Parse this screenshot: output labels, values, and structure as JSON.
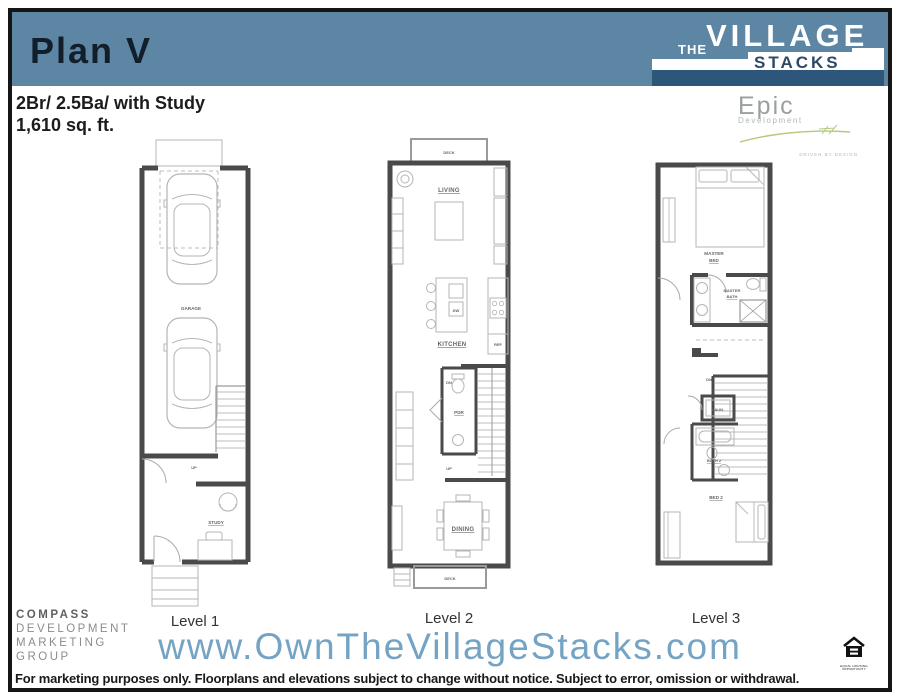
{
  "header": {
    "plan_name": "Plan V",
    "specs_line1": "2Br/ 2.5Ba/ with Study",
    "specs_line2": "1,610 sq. ft."
  },
  "brand": {
    "village": {
      "the": "THE",
      "village": "VILLAGE",
      "stacks": "STACKS"
    },
    "epic": {
      "name": "Epic",
      "division": "Development",
      "tagline": "DRIVEN BY DESIGN"
    }
  },
  "plans": {
    "level1": {
      "caption": "Level 1",
      "labels": {
        "garage": "GARAGE",
        "study": "STUDY",
        "up": "UP"
      }
    },
    "level2": {
      "caption": "Level 2",
      "labels": {
        "deck_top": "DECK",
        "living": "LIVING",
        "kitchen": "KITCHEN",
        "dw": "DW",
        "ref": "REF",
        "pdr": "PDR",
        "dn": "DN",
        "up": "UP",
        "dining": "DINING",
        "deck_bottom": "DECK"
      }
    },
    "level3": {
      "caption": "Level 3",
      "labels": {
        "master_1": "MASTER",
        "master_2": "BED",
        "bath_1": "MASTER",
        "bath_2": "BATH",
        "laundry": "LAUN.",
        "bath2": "BATH 2",
        "bed2": "BED 2",
        "dn": "DN"
      }
    }
  },
  "footer": {
    "compass_lines": [
      "COMPASS",
      "DEVELOPMENT",
      "MARKETING",
      "GROUP"
    ],
    "website": "www.OwnTheVillageStacks.com",
    "equal_housing": "EQUAL HOUSING OPPORTUNITY",
    "disclaimer": "For marketing purposes only. Floorplans and elevations subject to change without notice. Subject to error, omission or withdrawal."
  },
  "colors": {
    "header_blue": "#5d86a5",
    "logo_dark_blue": "#2e567a",
    "stacks_navy": "#2c4a68",
    "navy_text": "#121f2b",
    "url_blue": "#74a3c4",
    "wall_gray": "#4a4a4a",
    "furniture_gray": "#b5b5b5",
    "label_gray": "#666666",
    "epic_gray": "#9aa0a0",
    "signature_green": "#b5c87c",
    "compass_gray": "#8c8c8c"
  }
}
